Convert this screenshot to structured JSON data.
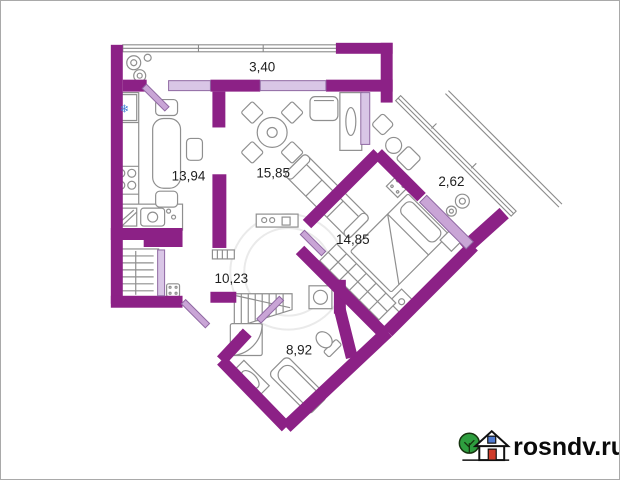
{
  "plan": {
    "type": "floor-plan",
    "rooms": [
      {
        "id": "balcony-top",
        "label": "3,40"
      },
      {
        "id": "kitchen",
        "label": "13,94"
      },
      {
        "id": "living-room",
        "label": "15,85"
      },
      {
        "id": "balcony-side",
        "label": "2,62"
      },
      {
        "id": "bedroom",
        "label": "14,85"
      },
      {
        "id": "hallway",
        "label": "10,23"
      },
      {
        "id": "bathroom",
        "label": "8,92"
      }
    ],
    "colors": {
      "wall": "#8c2186",
      "door_leaf": "#c9a5d6",
      "window_sill": "#d9c6e6",
      "furniture_line": "#8f8f8f",
      "label_text": "#1f1f1f"
    },
    "icons": {
      "fridge_snowflake": "❄"
    }
  },
  "watermark": {
    "text": "rosndv.ru",
    "icon": "house-with-tree",
    "colors": {
      "tree": "#2e9e3f",
      "house_door": "#cf3b2a",
      "house_window": "#4f79cf",
      "text": "#0a0a0a"
    }
  }
}
